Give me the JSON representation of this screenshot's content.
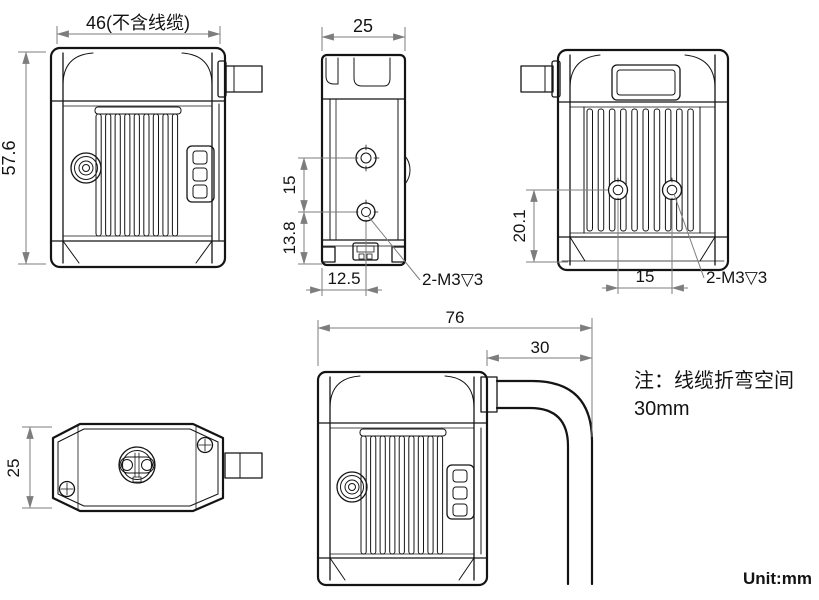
{
  "drawing": {
    "unit_label": "Unit:mm",
    "note": {
      "line1": "注：线缆折弯空间",
      "line2": "30mm"
    },
    "front_view": {
      "dim_width": "46(不含线缆)",
      "dim_height": "57.6"
    },
    "side_view": {
      "dim_depth": "25",
      "dim_hole_spacing": "15",
      "dim_hole_to_bottom": "13.8",
      "dim_hole_offset": "12.5",
      "thread_callout": "2-M3▽3"
    },
    "back_view": {
      "dim_hole_to_bottom": "20.1",
      "dim_hole_spacing": "15",
      "thread_callout": "2-M3▽3"
    },
    "top_view": {
      "dim_depth": "25"
    },
    "cable_view": {
      "dim_total": "76",
      "dim_bend": "30"
    }
  },
  "colors": {
    "background": "#ffffff",
    "outline": "#141414",
    "dimension_line": "#7d7d7d",
    "text": "#131313"
  }
}
